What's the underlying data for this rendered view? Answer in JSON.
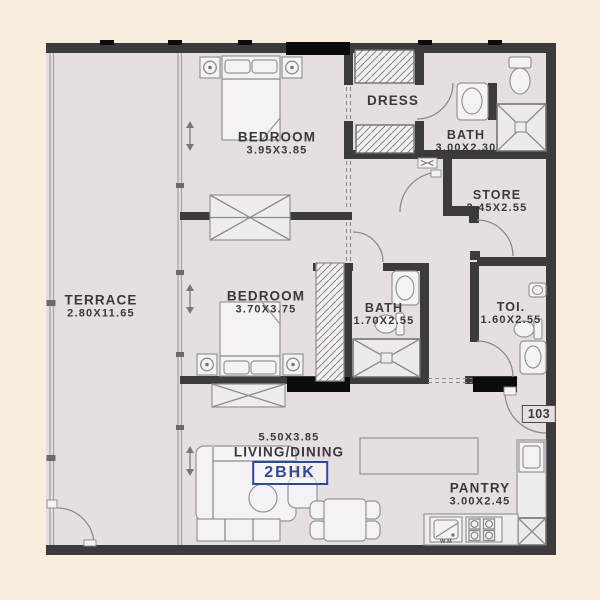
{
  "floorplan": {
    "unit_type_badge": "2BHK",
    "unit_number": "103",
    "rooms": {
      "terrace": {
        "name": "TERRACE",
        "dims": "2.80X11.65"
      },
      "bedroom1": {
        "name": "BEDROOM",
        "dims": "3.95X3.85"
      },
      "dress": {
        "name": "DRESS",
        "dims": ""
      },
      "bath1": {
        "name": "BATH",
        "dims": "3.00X2.30"
      },
      "store": {
        "name": "STORE",
        "dims": "2.45X2.55"
      },
      "bedroom2": {
        "name": "BEDROOM",
        "dims": "3.70X3.75"
      },
      "bath2": {
        "name": "BATH",
        "dims": "1.70X2.55"
      },
      "toilet": {
        "name": "TOI.",
        "dims": "1.60X2.55"
      },
      "living": {
        "name": "LIVING/DINING",
        "dims": "5.50X3.85"
      },
      "pantry": {
        "name": "PANTRY",
        "dims": "3.00X2.45",
        "appliance_label": "W.M"
      }
    },
    "colors": {
      "background": "#f9edde",
      "floor": "#e6dfe2",
      "wall": "#3d3a3c",
      "accent_blue": "#2d4a96"
    }
  }
}
